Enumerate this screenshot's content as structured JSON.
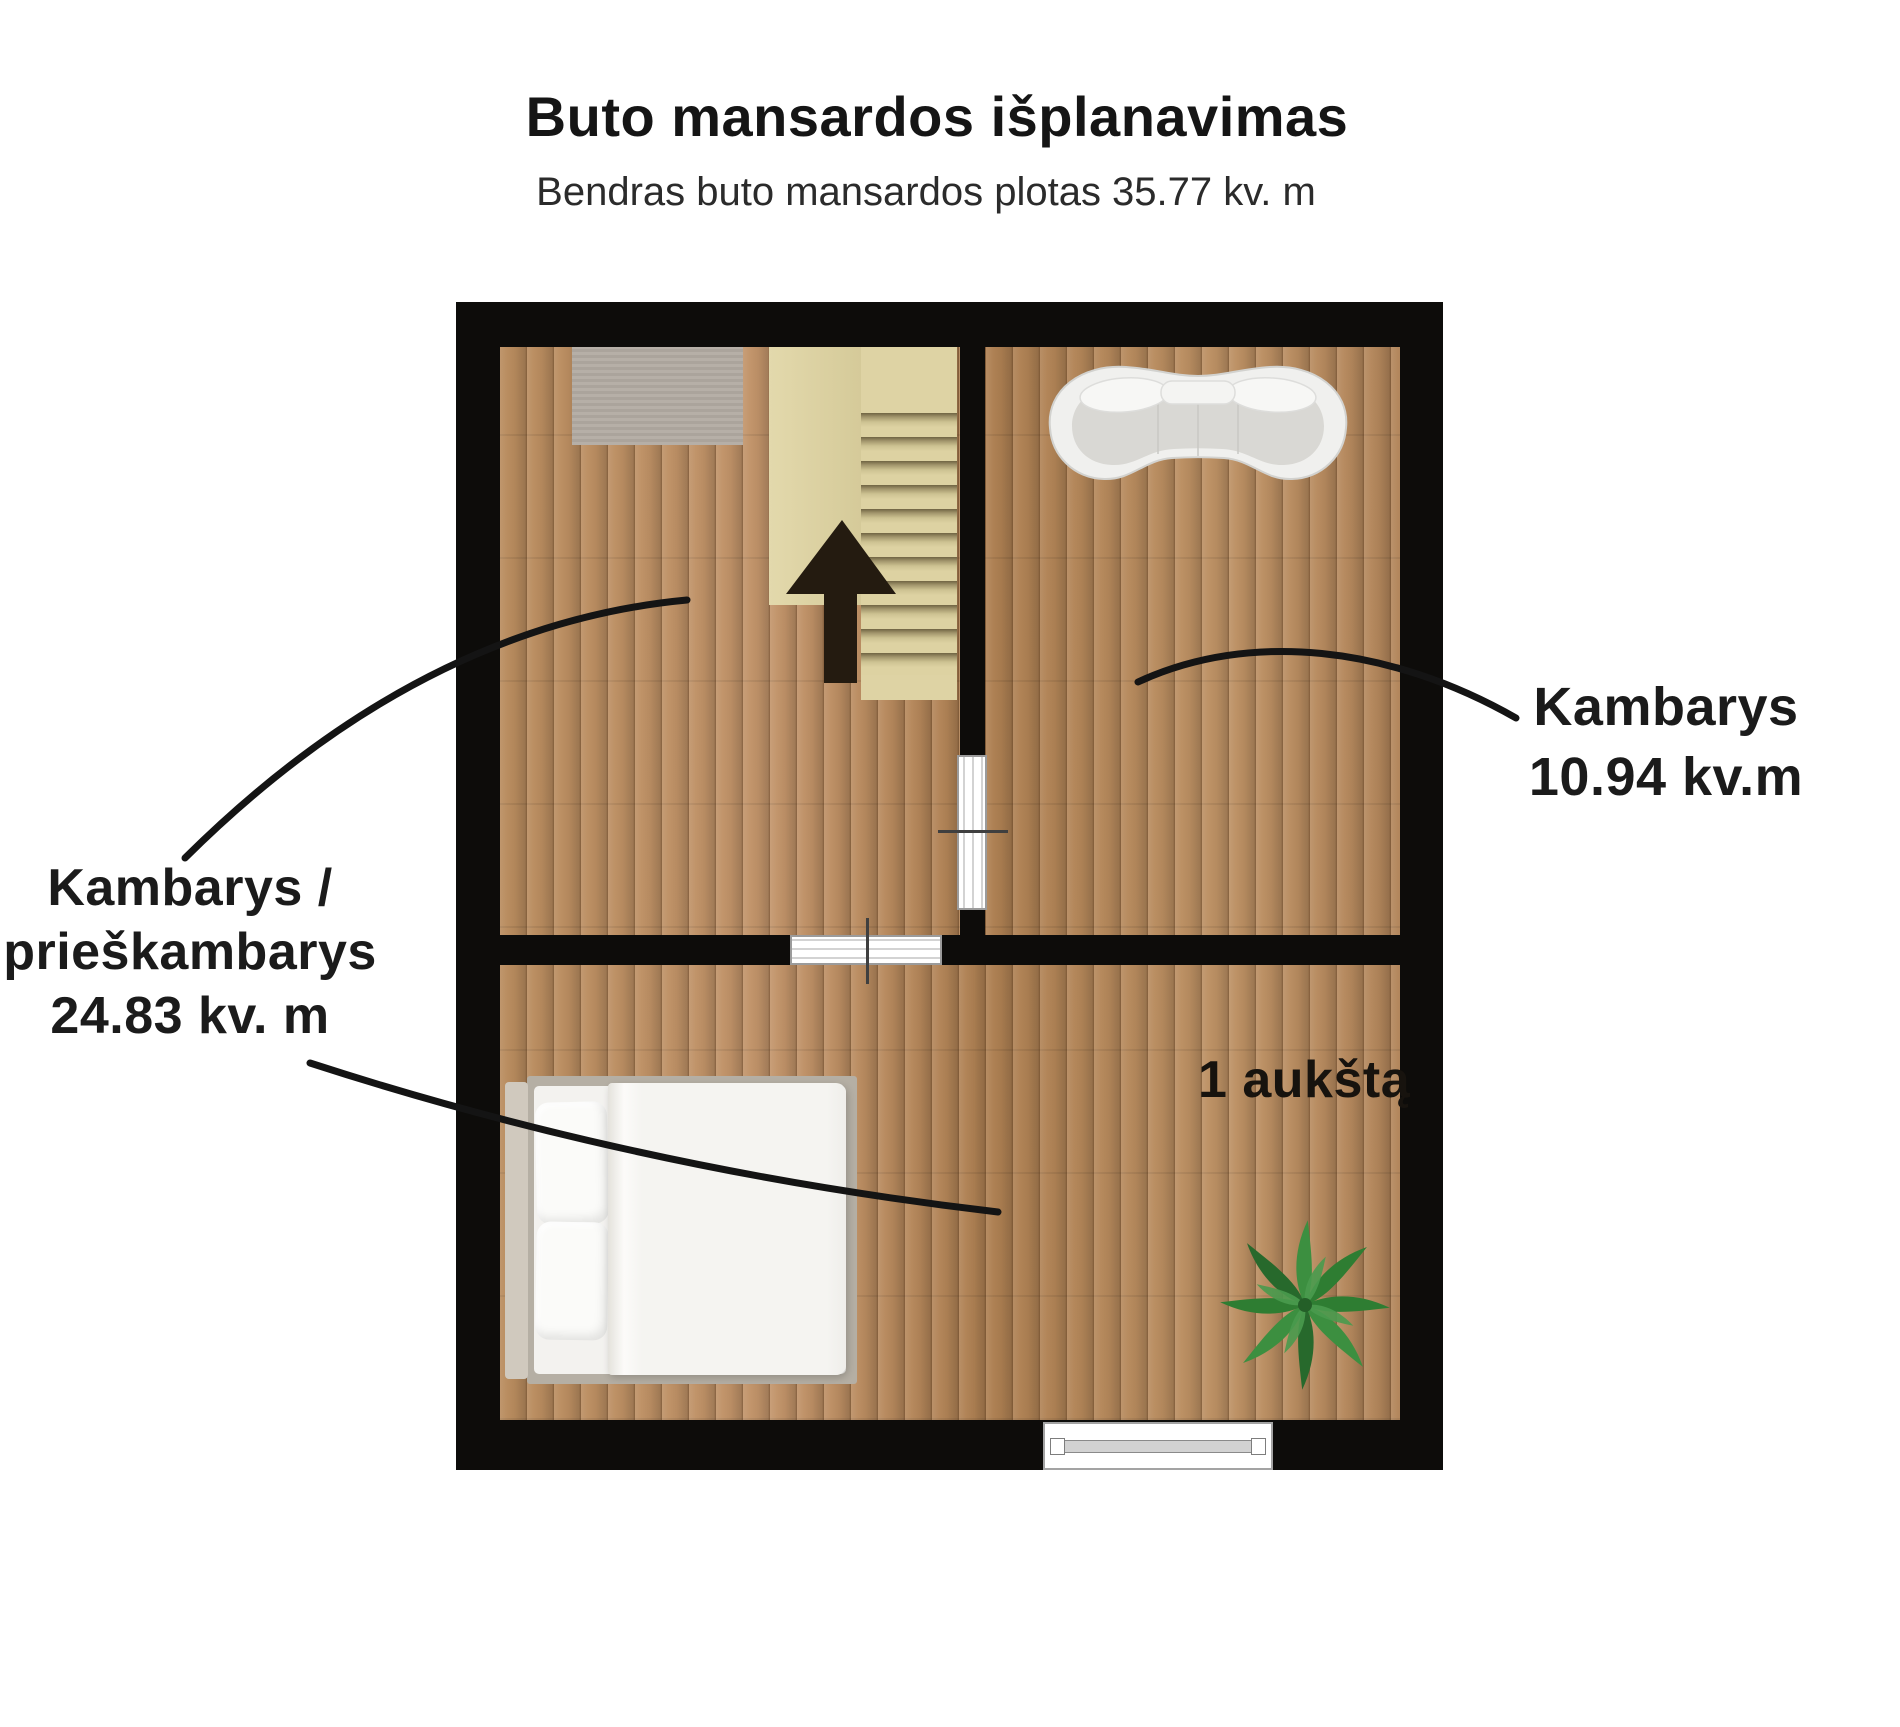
{
  "header": {
    "title": "Buto mansardos išplanavimas",
    "subtitle": "Bendras buto mansardos plotas 35.77 kv. m"
  },
  "labels": {
    "left_room": {
      "lines": [
        "Kambarys /",
        "prieškambarys",
        "24.83 kv. m"
      ],
      "area_value": "24.83 kv. m"
    },
    "right_room": {
      "lines": [
        "Kambarys",
        "10.94 kv.m"
      ],
      "area_value": "10.94 kv.m"
    },
    "stairs": "1 aukštą"
  },
  "icons": {
    "sofa": "curved-sofa-top-view",
    "bed": "double-bed-top-view",
    "plant": "palm-plant-top-view",
    "stairs": "staircase-up-arrow",
    "rug": "gray-rug",
    "window": "window-in-wall",
    "doors": "sliding-doors"
  },
  "colors": {
    "wall": "#0d0c0a",
    "floor_wood": "#b5895c",
    "stairs_beige": "#ded3a4",
    "rug_gray": "#b2aba2",
    "sofa_white": "#f0f0ee",
    "plant_green": "#2e7d32",
    "leader_line": "#141414",
    "text": "#1b1b1b"
  }
}
